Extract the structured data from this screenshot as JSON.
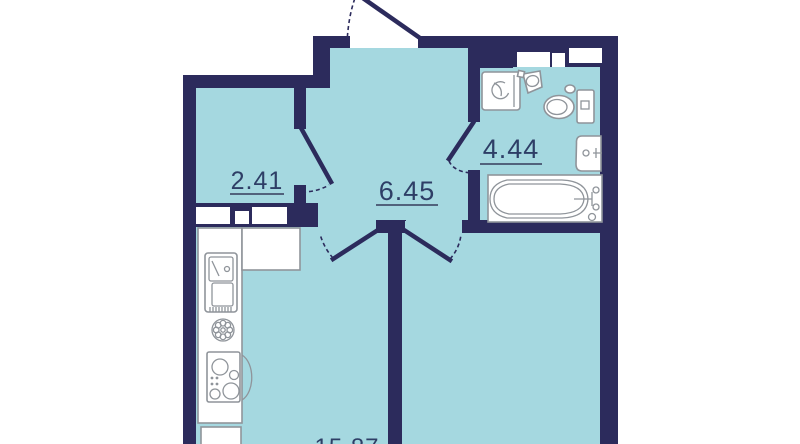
{
  "plan": {
    "title": "apartment-floor-plan",
    "rooms": [
      {
        "key": "wardrobe",
        "area": "2.41"
      },
      {
        "key": "hallway",
        "area": "6.45"
      },
      {
        "key": "bathroom",
        "area": "4.44"
      },
      {
        "key": "kitchen-living",
        "area": "15.87",
        "clipped_at_bottom_edge": true
      }
    ],
    "fixtures": [
      "washing-machine",
      "corner-hand-sink",
      "toilet",
      "vanity-sink",
      "bathtub",
      "kitchen-counter",
      "kitchen-sink-with-drainboard",
      "cooktop-stove",
      "round-hob-plate",
      "base-cabinet",
      "ventilation-shafts"
    ],
    "doors": [
      "entry-door",
      "wardrobe-door",
      "bathroom-door",
      "kitchen-door",
      "living-room-door"
    ],
    "colors": {
      "wall": "#2c2b5c",
      "floor": "#a5d8e0",
      "fixture_outline": "#8f949a",
      "label_text": "#2e3e66",
      "underline": "#51627c",
      "background": "#ffffff"
    }
  }
}
